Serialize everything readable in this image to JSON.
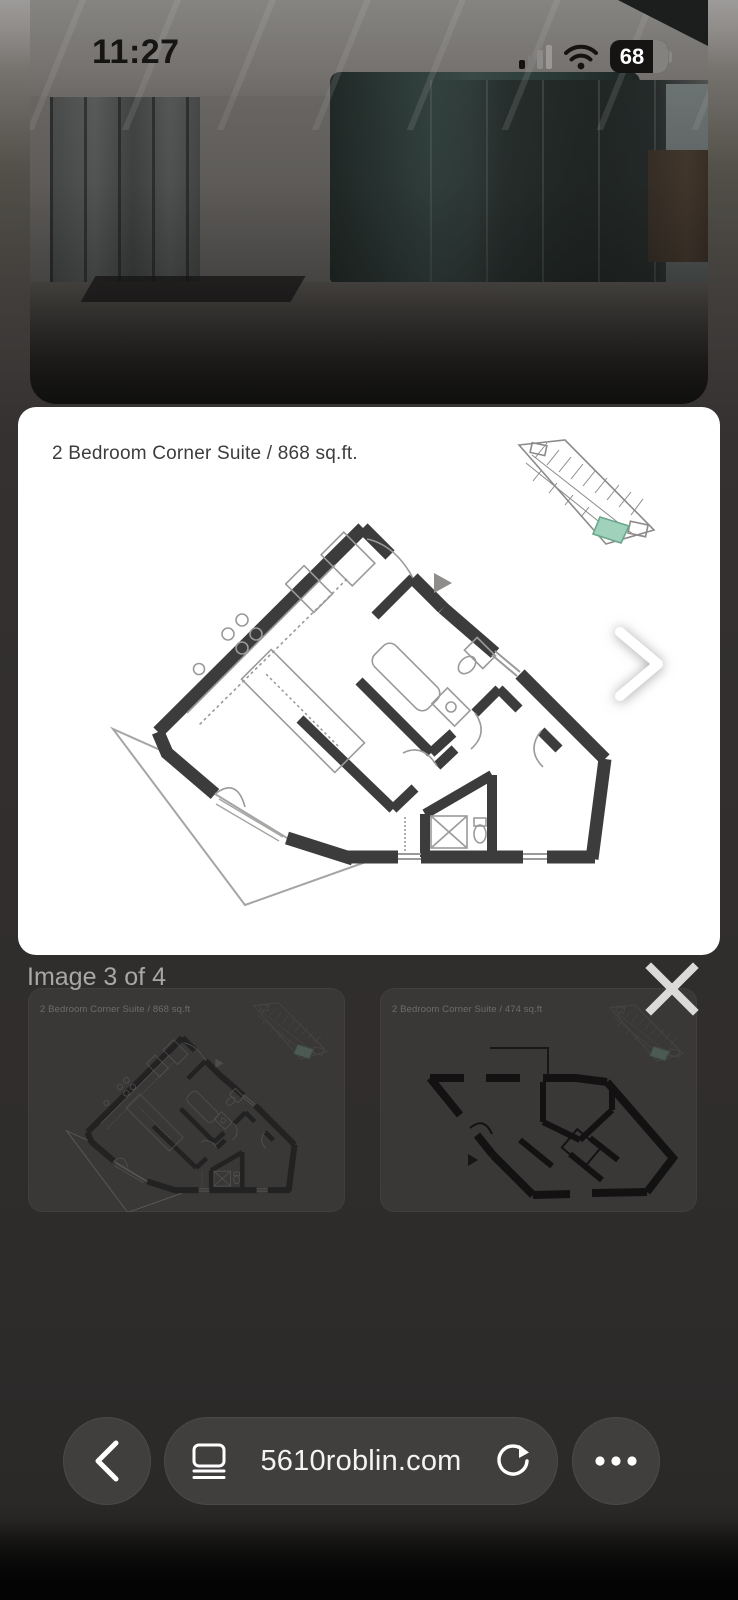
{
  "status_bar": {
    "time": "11:27",
    "battery": "68"
  },
  "lightbox": {
    "counter": "Image 3 of 4",
    "main_image": {
      "title": "2 Bedroom Corner Suite / 868 sq.ft."
    },
    "thumbnails": [
      {
        "caption": "2 Bedroom Corner Suite / 868 sq.ft"
      },
      {
        "caption": "2 Bedroom Corner Suite / 474 sq.ft"
      }
    ],
    "accent_teal": "#9fd1bb"
  },
  "browser": {
    "url": "5610roblin.com"
  }
}
